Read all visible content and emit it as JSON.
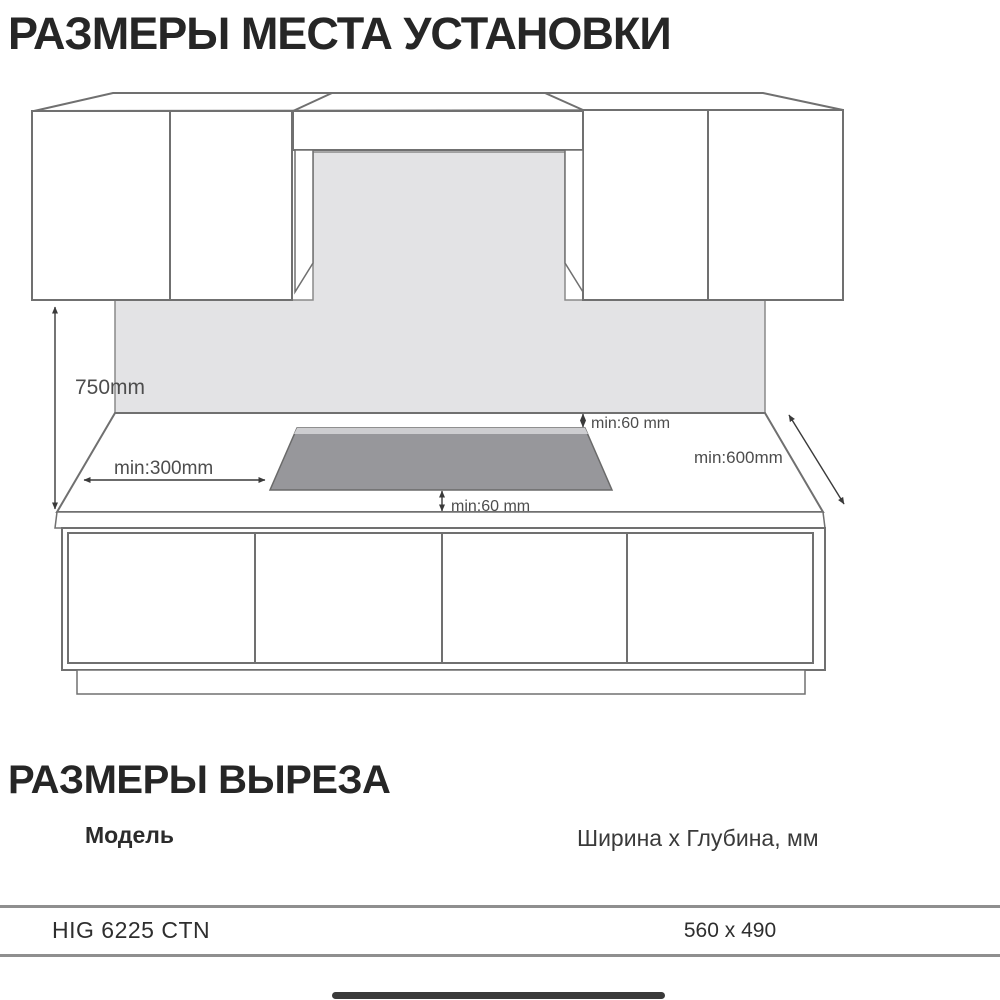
{
  "page": {
    "title_installation": "РАЗМЕРЫ МЕСТА УСТАНОВКИ",
    "title_cutout": "РАЗМЕРЫ ВЫРЕЗА"
  },
  "diagram": {
    "labels": {
      "height_750": "750mm",
      "min_300": "min:300mm",
      "min_60_top": "min:60 mm",
      "min_60_bottom": "min:60 mm",
      "min_600": "min:600mm"
    },
    "colors": {
      "backsplash": "#e3e3e5",
      "cooktop": "#97979b",
      "cooktop_edge": "#cdcdd0",
      "line": "#707070",
      "dimension": "#3a3a3a"
    }
  },
  "cutout_table": {
    "columns": [
      "Модель",
      "Ширина x Глубина, мм"
    ],
    "rows": [
      {
        "model": "HIG 6225 CTN",
        "size": "560 x 490"
      }
    ]
  }
}
